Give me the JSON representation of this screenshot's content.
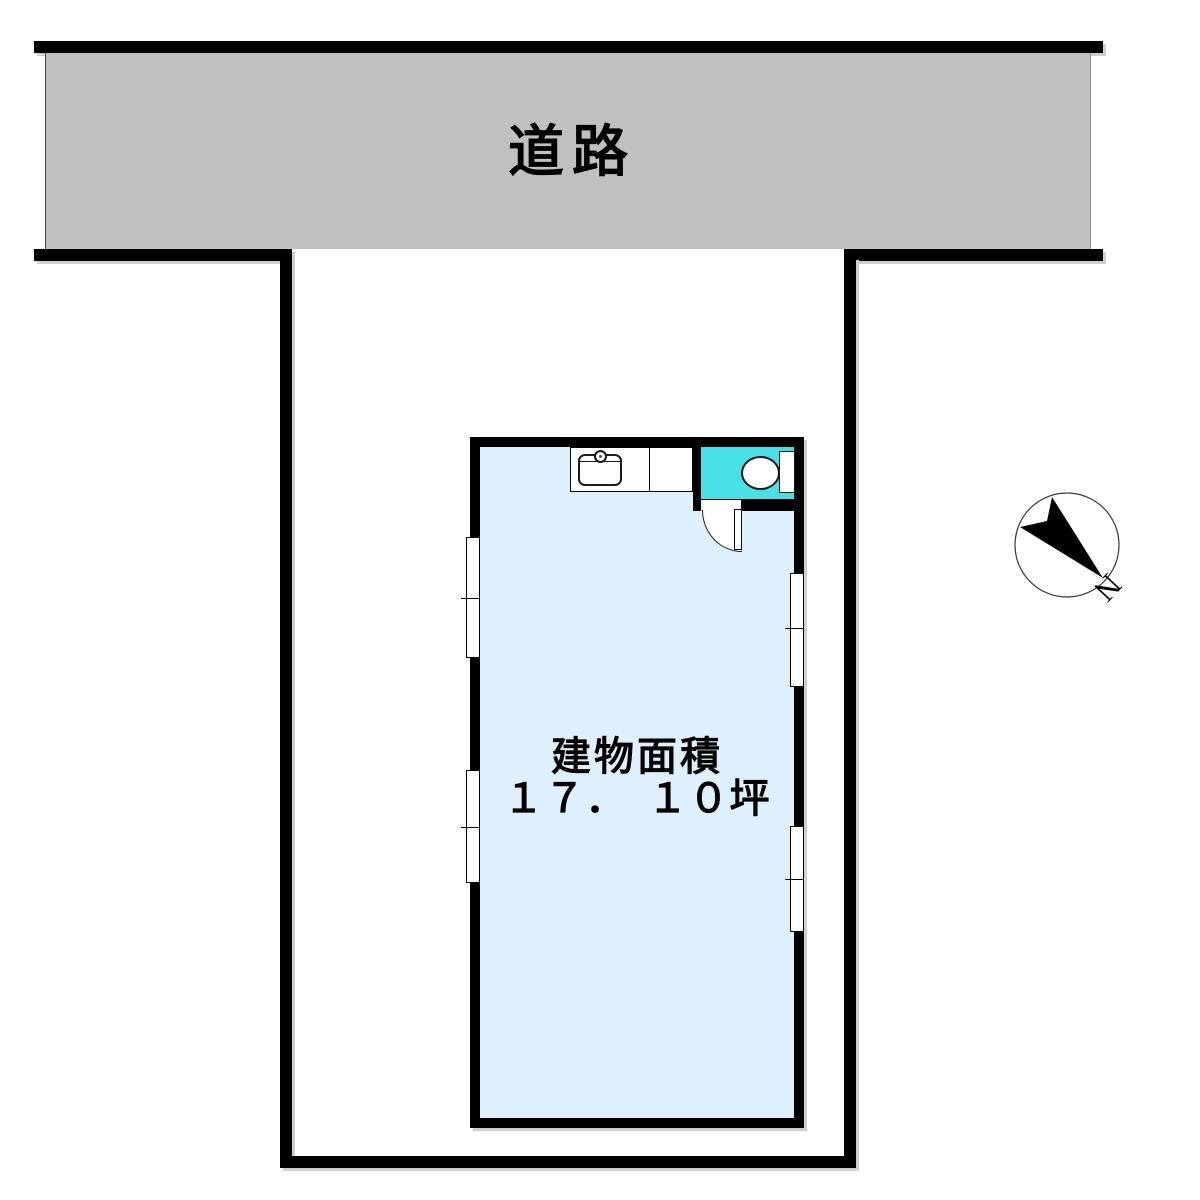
{
  "plan": {
    "type": "site-floor-plan",
    "background_color": "#ffffff"
  },
  "road": {
    "label": "道路",
    "surface_color": "#c0c0c0",
    "edge_bar_color": "#000000"
  },
  "property": {
    "boundary_color": "#000000"
  },
  "building": {
    "interior_color": "#def0fb",
    "wall_color": "#000000",
    "area_label_line1": "建物面積",
    "area_label_line2": "１７．　１０坪",
    "area_value_tsubo": "17.10"
  },
  "bathroom": {
    "floor_color": "#49dfe5",
    "fixtures": [
      "toilet-bowl",
      "toilet-tank"
    ]
  },
  "kitchen": {
    "fixtures": [
      "counter",
      "sink",
      "faucet"
    ]
  },
  "openings": {
    "windows": [
      "left-wall-upper",
      "left-wall-lower",
      "right-wall-upper",
      "right-wall-lower"
    ],
    "door": "hinged-door-swing-inward"
  },
  "compass": {
    "north_label": "N",
    "arrow_color": "#000000",
    "direction": "south-east-on-screen"
  }
}
